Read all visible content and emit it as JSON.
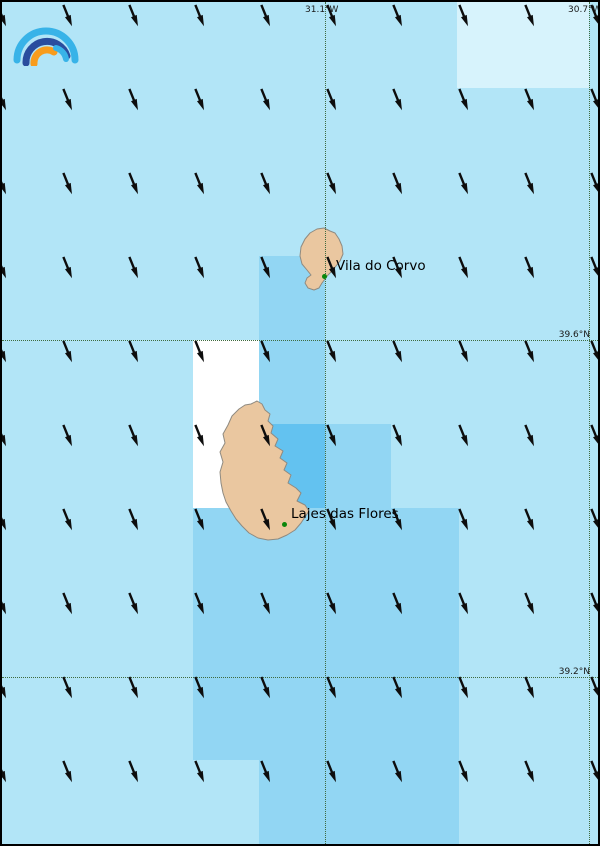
{
  "map": {
    "width": 600,
    "height": 846,
    "colors": {
      "base": "#b2e5f7",
      "pale": "#d7f3fc",
      "medium": "#92d6f3",
      "bright": "#63c2f0",
      "white": "#ffffff",
      "land": "#eac7a0",
      "land_outline": "#8f8a80",
      "marker": "#0b860b",
      "grid_line": "#3f6b3f",
      "arrow": "#0d0d0d",
      "border": "#000000"
    },
    "cells": [
      {
        "x": 455,
        "y": 0,
        "w": 132,
        "h": 86,
        "color": "pale"
      },
      {
        "x": 257,
        "y": 254,
        "w": 66,
        "h": 168,
        "color": "medium"
      },
      {
        "x": 191,
        "y": 338,
        "w": 66,
        "h": 168,
        "color": "white"
      },
      {
        "x": 257,
        "y": 422,
        "w": 66,
        "h": 84,
        "color": "bright"
      },
      {
        "x": 323,
        "y": 422,
        "w": 66,
        "h": 84,
        "color": "medium"
      },
      {
        "x": 191,
        "y": 506,
        "w": 66,
        "h": 252,
        "color": "medium"
      },
      {
        "x": 257,
        "y": 506,
        "w": 200,
        "h": 336,
        "color": "medium"
      }
    ],
    "graticule": {
      "verticals": [
        {
          "x": 323,
          "label": "31.1°W"
        },
        {
          "x": 587,
          "label": "30.7°W"
        }
      ],
      "horizontals": [
        {
          "y": 338,
          "label": "39.6°N"
        },
        {
          "y": 675,
          "label": "39.2°N"
        }
      ]
    },
    "cities": [
      {
        "name": "Vila do Corvo",
        "dot_x": 322,
        "dot_y": 274,
        "label_x": 334,
        "label_y": 257
      },
      {
        "name": "Lajes das Flores",
        "dot_x": 282,
        "dot_y": 522,
        "label_x": 289,
        "label_y": 505
      }
    ],
    "wind": {
      "cols": [
        -5,
        61,
        127,
        193,
        259,
        325,
        391,
        457,
        523,
        589
      ],
      "rows": [
        2,
        86,
        170,
        254,
        338,
        422,
        506,
        590,
        674,
        758,
        842
      ],
      "angle_deg": -22,
      "stem_len": 14,
      "head_len": 8,
      "stroke_width": 2.4
    },
    "logo": {
      "name": "rainbow-arcs-logo",
      "arc_colors": [
        "#38b3e8",
        "#2a4d9e",
        "#f89c1c",
        "#38b3e8"
      ]
    }
  }
}
